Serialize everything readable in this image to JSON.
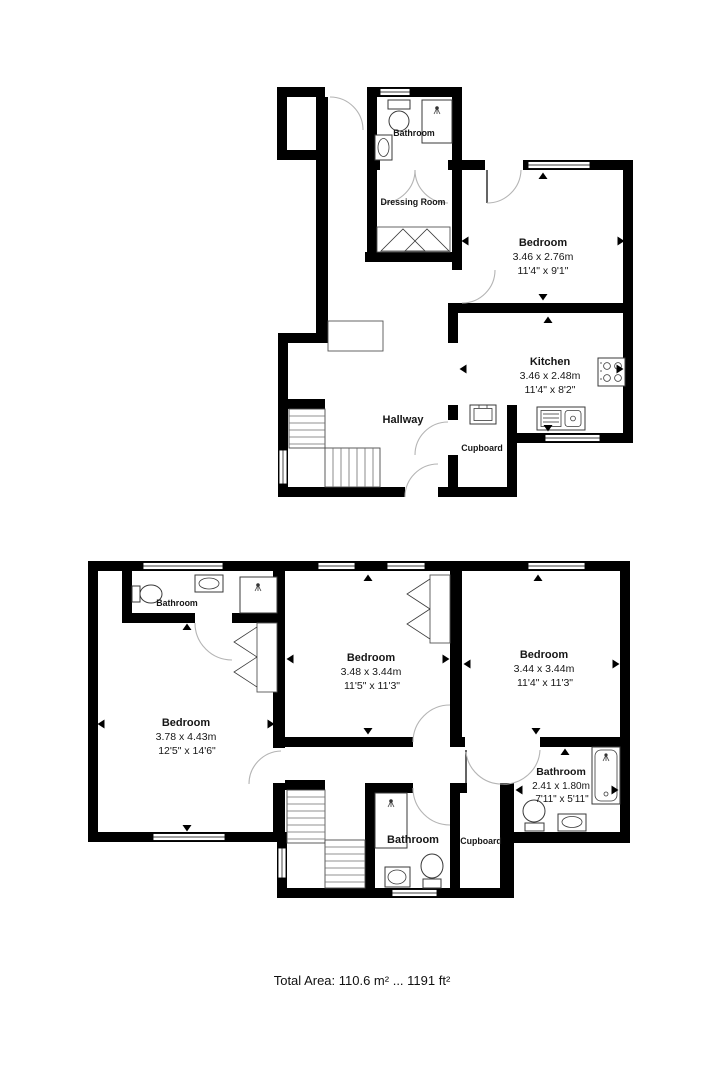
{
  "colors": {
    "background": "#ffffff",
    "wall": "#000000",
    "door_arc": "#b4b4b4"
  },
  "upper_floor": {
    "rooms": {
      "bathroom": {
        "name": "Bathroom"
      },
      "dressing_room": {
        "name": "Dressing Room"
      },
      "bedroom": {
        "name": "Bedroom",
        "size_metric": "3.46 x 2.76m",
        "size_imperial": "11'4\" x 9'1\""
      },
      "kitchen": {
        "name": "Kitchen",
        "size_metric": "3.46 x 2.48m",
        "size_imperial": "11'4\" x 8'2\""
      },
      "hallway": {
        "name": "Hallway"
      },
      "cupboard": {
        "name": "Cupboard"
      }
    }
  },
  "lower_floor": {
    "rooms": {
      "bathroom_ensuite": {
        "name": "Bathroom"
      },
      "bedroom_left": {
        "name": "Bedroom",
        "size_metric": "3.78 x 4.43m",
        "size_imperial": "12'5\" x 14'6\""
      },
      "bedroom_middle": {
        "name": "Bedroom",
        "size_metric": "3.48 x 3.44m",
        "size_imperial": "11'5\" x 11'3\""
      },
      "bedroom_right": {
        "name": "Bedroom",
        "size_metric": "3.44 x 3.44m",
        "size_imperial": "11'4\" x 11'3\""
      },
      "bathroom_right": {
        "name": "Bathroom",
        "size_metric": "2.41 x 1.80m",
        "size_imperial": "7'11\" x 5'11\""
      },
      "bathroom_middle": {
        "name": "Bathroom"
      },
      "cupboard": {
        "name": "Cupboard"
      }
    }
  },
  "footer": {
    "total_area": "Total Area: 110.6 m² ... 1191 ft²"
  }
}
